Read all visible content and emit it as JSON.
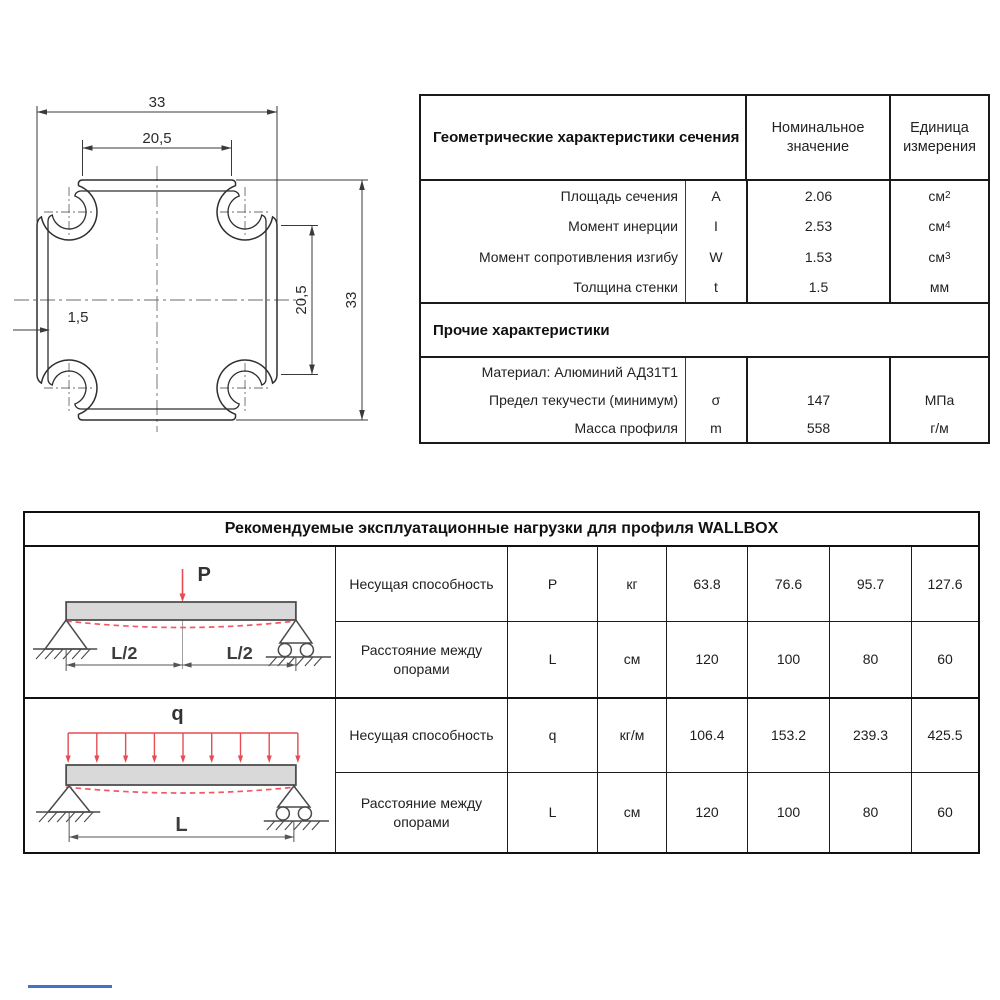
{
  "drawing": {
    "dim_top_outer": "33",
    "dim_top_inner": "20,5",
    "dim_right_inner": "20,5",
    "dim_right_outer": "33",
    "dim_wall_thickness": "1,5"
  },
  "geometry_table": {
    "title": "Геометрические характеристики сечения",
    "col_nominal": "Номинальное значение",
    "col_unit": "Единица измерения",
    "rows": [
      {
        "label": "Площадь сечения",
        "symbol": "A",
        "value": "2.06",
        "unit": "см",
        "unit_sup": "2"
      },
      {
        "label": "Момент инерции",
        "symbol": "I",
        "value": "2.53",
        "unit": "см",
        "unit_sup": "4"
      },
      {
        "label": "Момент сопротивления изгибу",
        "symbol": "W",
        "value": "1.53",
        "unit": "см",
        "unit_sup": "3"
      },
      {
        "label": "Толщина стенки",
        "symbol": "t",
        "value": "1.5",
        "unit": "мм",
        "unit_sup": ""
      }
    ],
    "section2_title": "Прочие характеристики",
    "rows2": [
      {
        "label": "Материал: Алюминий АД31Т1",
        "symbol": "",
        "value": "",
        "unit": "",
        "unit_sup": ""
      },
      {
        "label": "Предел текучести (минимум)",
        "symbol": "σ",
        "value": "147",
        "unit": "МПа",
        "unit_sup": ""
      },
      {
        "label": "Масса профиля",
        "symbol": "m",
        "value": "558",
        "unit": "г/м",
        "unit_sup": ""
      }
    ]
  },
  "loads_table": {
    "title": "Рекомендуемые эксплуатационные нагрузки для профиля WALLBOX",
    "diagram_point": {
      "load_label": "P",
      "dim_left": "L/2",
      "dim_right": "L/2"
    },
    "diagram_distributed": {
      "load_label": "q",
      "dim_label": "L"
    },
    "rows": [
      {
        "label": "Несущая способность",
        "symbol": "P",
        "unit": "кг",
        "values": [
          "63.8",
          "76.6",
          "95.7",
          "127.6"
        ]
      },
      {
        "label": "Расстояние между опорами",
        "symbol": "L",
        "unit": "см",
        "values": [
          "120",
          "100",
          "80",
          "60"
        ]
      },
      {
        "label": "Несущая способность",
        "symbol": "q",
        "unit": "кг/м",
        "values": [
          "106.4",
          "153.2",
          "239.3",
          "425.5"
        ]
      },
      {
        "label": "Расстояние между опорами",
        "symbol": "L",
        "unit": "см",
        "values": [
          "120",
          "100",
          "80",
          "60"
        ]
      }
    ]
  }
}
